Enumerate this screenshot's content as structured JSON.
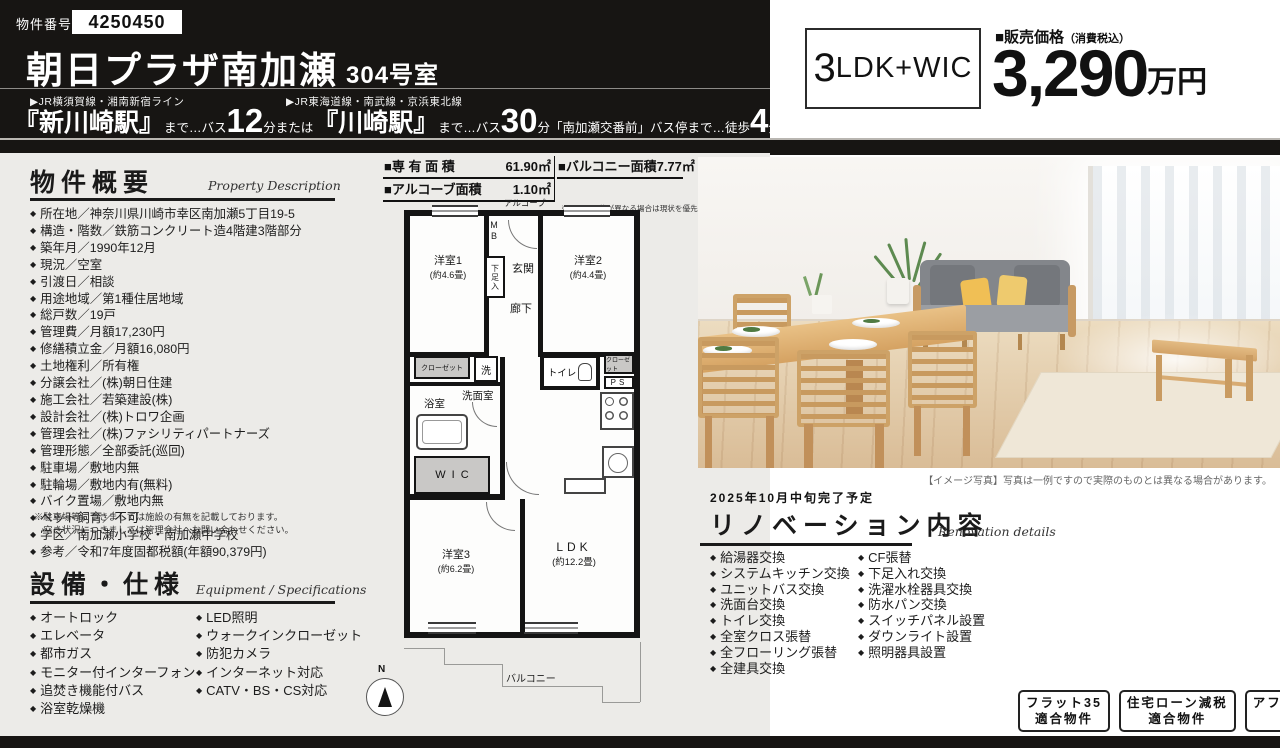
{
  "colors": {
    "ink": "#171513",
    "panel_gray": "#ecebe8",
    "closet_gray": "#c9c8c6",
    "wood": "#d7a467",
    "sofa_gray": "#85888c",
    "cushion_yellow": "#f0c05a"
  },
  "header": {
    "property_number_label": "物件番号",
    "property_number": "4250450",
    "title": "朝日プラザ南加瀬",
    "unit": "304号室",
    "access": {
      "rail1": "▶JR横須賀線・湘南新宿ライン",
      "rail2": "▶JR東海道線・南武線・京浜東北線",
      "s1": "『新川崎駅』",
      "m1": "まで…バス",
      "n1": "12",
      "m2": "分または",
      "s2": "『川崎駅』",
      "m3": "まで…バス",
      "n2": "30",
      "m4": "分「南加瀬交番前」バス停まで…徒歩",
      "n3": "4",
      "m5": "分"
    }
  },
  "price_panel": {
    "layout_num": "3",
    "layout_text": "LDK+WIC",
    "price_label": "■販売価格",
    "price_label_small": "（消費税込）",
    "price_value": "3,290",
    "price_unit": "万円"
  },
  "overview": {
    "title": "物件概要",
    "subtitle_en": "Property Description",
    "items": [
      "所在地／神奈川県川崎市幸区南加瀬5丁目19-5",
      "構造・階数／鉄筋コンクリート造4階建3階部分",
      "築年月／1990年12月",
      "現況／空室",
      "引渡日／相談",
      "用途地域／第1種住居地域",
      "総戸数／19戸",
      "管理費／月額17,230円",
      "修繕積立金／月額16,080円",
      "土地権利／所有権",
      "分譲会社／(株)朝日住建",
      "施工会社／若築建設(株)",
      "設計会社／(株)トロワ企画",
      "管理会社／(株)ファシリティパートナーズ",
      "管理形態／全部委託(巡回)",
      "駐車場／敷地内無",
      "駐輪場／敷地内有(無料)",
      "バイク置場／敷地内無",
      "ペット飼育／不可",
      "学区／南加瀬小学校・南加瀬中学校",
      "参考／令和7年度固都税額(年額90,379円)"
    ],
    "note1": "※駐車場等につきましては施設の有無を記載しております。",
    "note2": "　空き状況につきましては管理会社へお問い合わせください。"
  },
  "equipment": {
    "title": "設備・仕様",
    "subtitle_en": "Equipment / Specifications",
    "col1": [
      "オートロック",
      "エレベータ",
      "都市ガス",
      "モニター付インターフォン",
      "追焚き機能付バス",
      "浴室乾燥機"
    ],
    "col2": [
      "LED照明",
      "ウォークインクローゼット",
      "防犯カメラ",
      "インターネット対応",
      "CATV・BS・CS対応"
    ]
  },
  "areas": {
    "a1_label": "■専 有 面 積",
    "a1_value": "61.90㎡",
    "a2_label": "■バルコニー面積",
    "a2_value": "7.77㎡",
    "a3_label": "■アルコーブ面積",
    "a3_value": "1.10㎡",
    "note": "※図面と現状が異なる場合は現状を優先といたします。"
  },
  "floorplan": {
    "alcove": "アルコーブ",
    "mb": "MB",
    "genkan": "玄関",
    "shoebox": "下足入",
    "hall": "廊下",
    "room1": "洋室1",
    "room1_size": "(約4.6畳)",
    "room2": "洋室2",
    "room2_size": "(約4.4畳)",
    "closet": "クローゼット",
    "washer": "洗",
    "toilet": "トイレ",
    "ps": "PS",
    "senmen": "洗面室",
    "bath": "浴室",
    "wic": "WIC",
    "room3": "洋室3",
    "room3_size": "(約6.2畳)",
    "ldk": "LDK",
    "ldk_size": "(約12.2畳)",
    "balcony": "バルコニー",
    "north": "N"
  },
  "photo": {
    "caption": "【イメージ写真】写真は一例ですので実際のものとは異なる場合があります。"
  },
  "renovation": {
    "schedule": "2025年10月中旬完了予定",
    "title": "リノベーション内容",
    "subtitle_en": "Renovation details",
    "col1": [
      "給湯器交換",
      "システムキッチン交換",
      "ユニットバス交換",
      "洗面台交換",
      "トイレ交換",
      "全室クロス張替",
      "全フローリング張替",
      "全建具交換"
    ],
    "col2": [
      "CF張替",
      "下足入れ交換",
      "洗濯水栓器具交換",
      "防水パン交換",
      "スイッチパネル設置",
      "ダウンライト設置",
      "照明器具設置"
    ]
  },
  "badges": [
    {
      "l1": "フラット35",
      "l2": "適合物件"
    },
    {
      "l1": "住宅ローン減税",
      "l2": "適合物件"
    },
    {
      "l1": "アフターサービス",
      "l2": "保証付"
    }
  ]
}
